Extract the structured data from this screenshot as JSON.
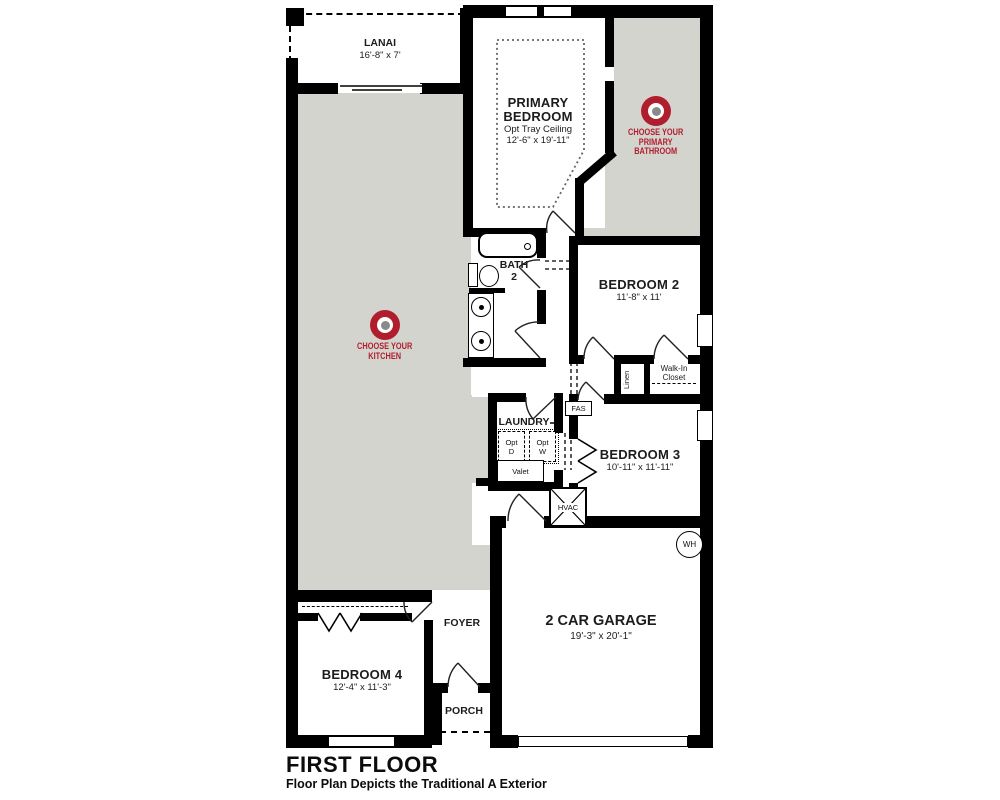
{
  "colors": {
    "accent_red": "#b01e2e",
    "target_center": "#8a8a8a",
    "room_gray": "#d4d4cf",
    "wall": "#000000"
  },
  "rooms": {
    "lanai": {
      "name": "LANAI",
      "dims": "16'-8\" x 7'"
    },
    "primary_bedroom": {
      "name": "PRIMARY BEDROOM",
      "note": "Opt Tray Ceiling",
      "dims": "12'-6\" x 19'-11\""
    },
    "bedroom2": {
      "name": "BEDROOM 2",
      "dims": "11'-8\" x 11'"
    },
    "bedroom3": {
      "name": "BEDROOM 3",
      "dims": "10'-11\" x 11'-11\""
    },
    "bedroom4": {
      "name": "BEDROOM 4",
      "dims": "12'-4\" x 11'-3\""
    },
    "garage": {
      "name": "2 CAR GARAGE",
      "dims": "19'-3\" x 20'-1\""
    },
    "bath2": {
      "line1": "BATH",
      "line2": "2"
    },
    "laundry": {
      "name": "LAUNDRY"
    },
    "foyer": {
      "name": "FOYER"
    },
    "porch": {
      "name": "PORCH"
    },
    "linen": {
      "name": "Linen"
    },
    "walk_in_closet": {
      "line1": "Walk-In",
      "line2": "Closet"
    },
    "valet": {
      "name": "Valet"
    },
    "hvac": {
      "name": "HVAC"
    },
    "water_heater": {
      "name": "WH"
    },
    "fas": {
      "name": "FAS"
    },
    "opt_dryer": {
      "line1": "Opt",
      "line2": "D"
    },
    "opt_washer": {
      "line1": "Opt",
      "line2": "W"
    }
  },
  "hotspots": {
    "kitchen": {
      "line1": "CHOOSE YOUR",
      "line2": "KITCHEN"
    },
    "primary_bath": {
      "line1": "CHOOSE YOUR",
      "line2": "PRIMARY",
      "line3": "BATHROOM"
    }
  },
  "footer": {
    "title": "FIRST FLOOR",
    "subtitle": "Floor Plan Depicts the Traditional A Exterior"
  }
}
